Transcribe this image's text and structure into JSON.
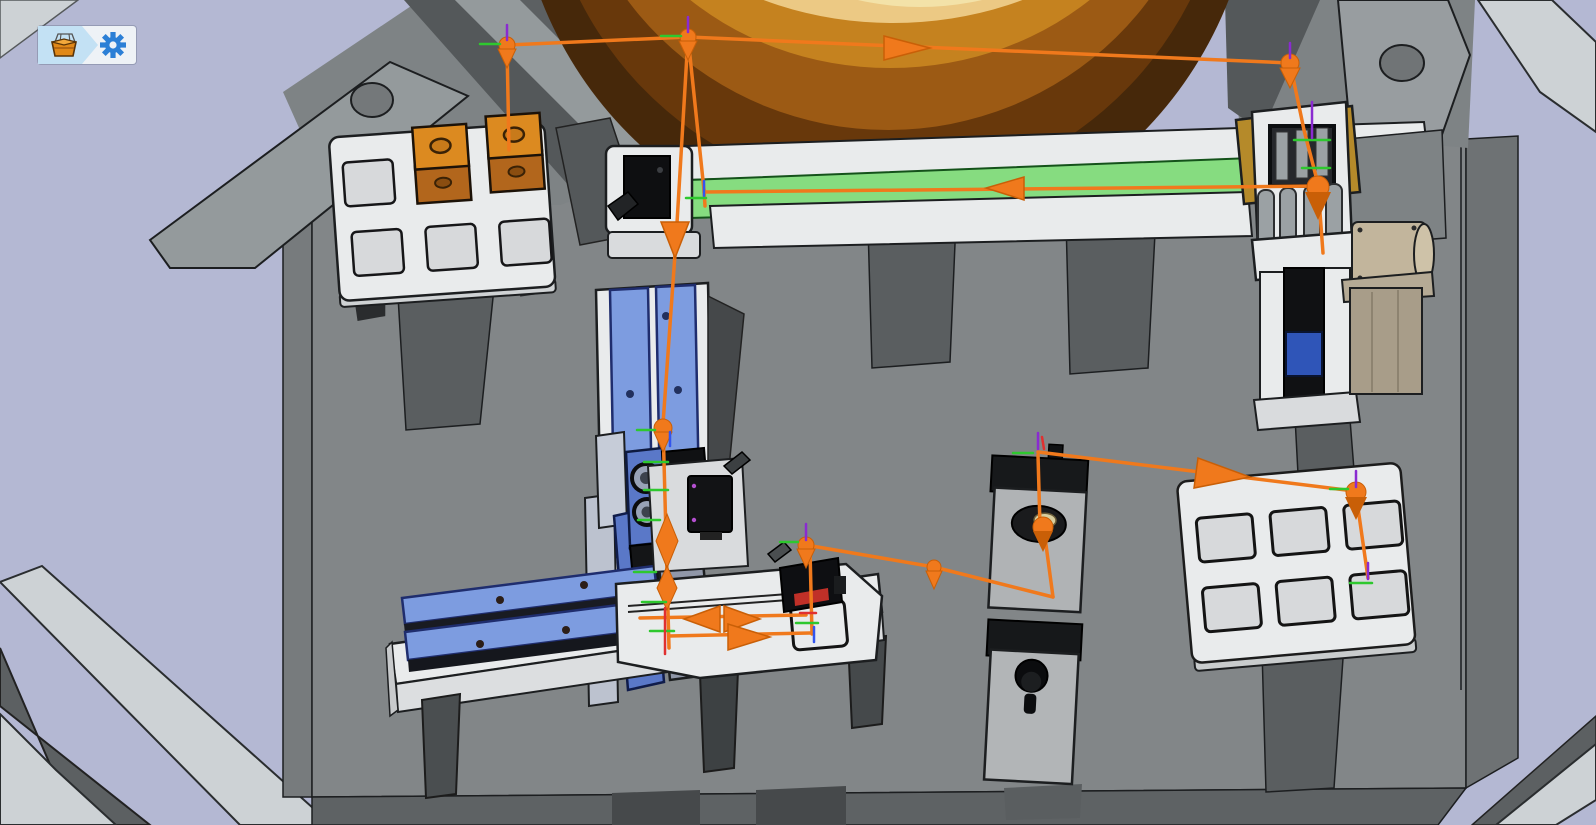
{
  "app": {
    "view": "3d-simulation-viewport",
    "toolbar": {
      "buttons": [
        {
          "id": "parts-bin",
          "icon": "crate-icon"
        },
        {
          "id": "settings",
          "icon": "gear-icon"
        }
      ]
    }
  },
  "colors": {
    "background": "#b4b8d3",
    "baseplate": "#828688",
    "baseplate_side": "#6e7274",
    "trajectory": "#f0791c",
    "trajectory_dark": "#c95f07",
    "conveyor_green": "#86dc80",
    "rail_blue": "#7d9ce0",
    "actuator_blue": "#5a78c8",
    "part_orange": "#dc8a20",
    "bowl_outer": "#46280a",
    "bowl_mid": "#9c5a14",
    "bowl_top": "#f3e2a8",
    "tray_white": "#e9ebec",
    "gold": "#b58a2a",
    "motor_beige": "#c2b59c",
    "axis_green": "#2ec82e",
    "axis_blue": "#3355ee",
    "axis_red": "#e03030",
    "axis_purple": "#8a2bd0",
    "gear_blue": "#2b7fd6",
    "button_blue": "#c3e1f4",
    "sensor_red_stripe": "#c03028"
  },
  "scene": {
    "components": [
      "bowl-feeder",
      "machine-frame",
      "baseplate",
      "input-tray",
      "linear-conveyor",
      "conveyor-sensor",
      "pick-place-unit",
      "vertical-slide",
      "gripper",
      "horizontal-slide-table",
      "fixture-plate",
      "inspection-stand",
      "knob-stand",
      "output-tray"
    ],
    "input_tray": {
      "slots": 6,
      "filled_slots": 2
    },
    "output_tray": {
      "slots": 6,
      "filled_slots": 0
    },
    "trajectory": {
      "color": "#f0791c",
      "waypoints": 12,
      "arrows": 7
    }
  }
}
